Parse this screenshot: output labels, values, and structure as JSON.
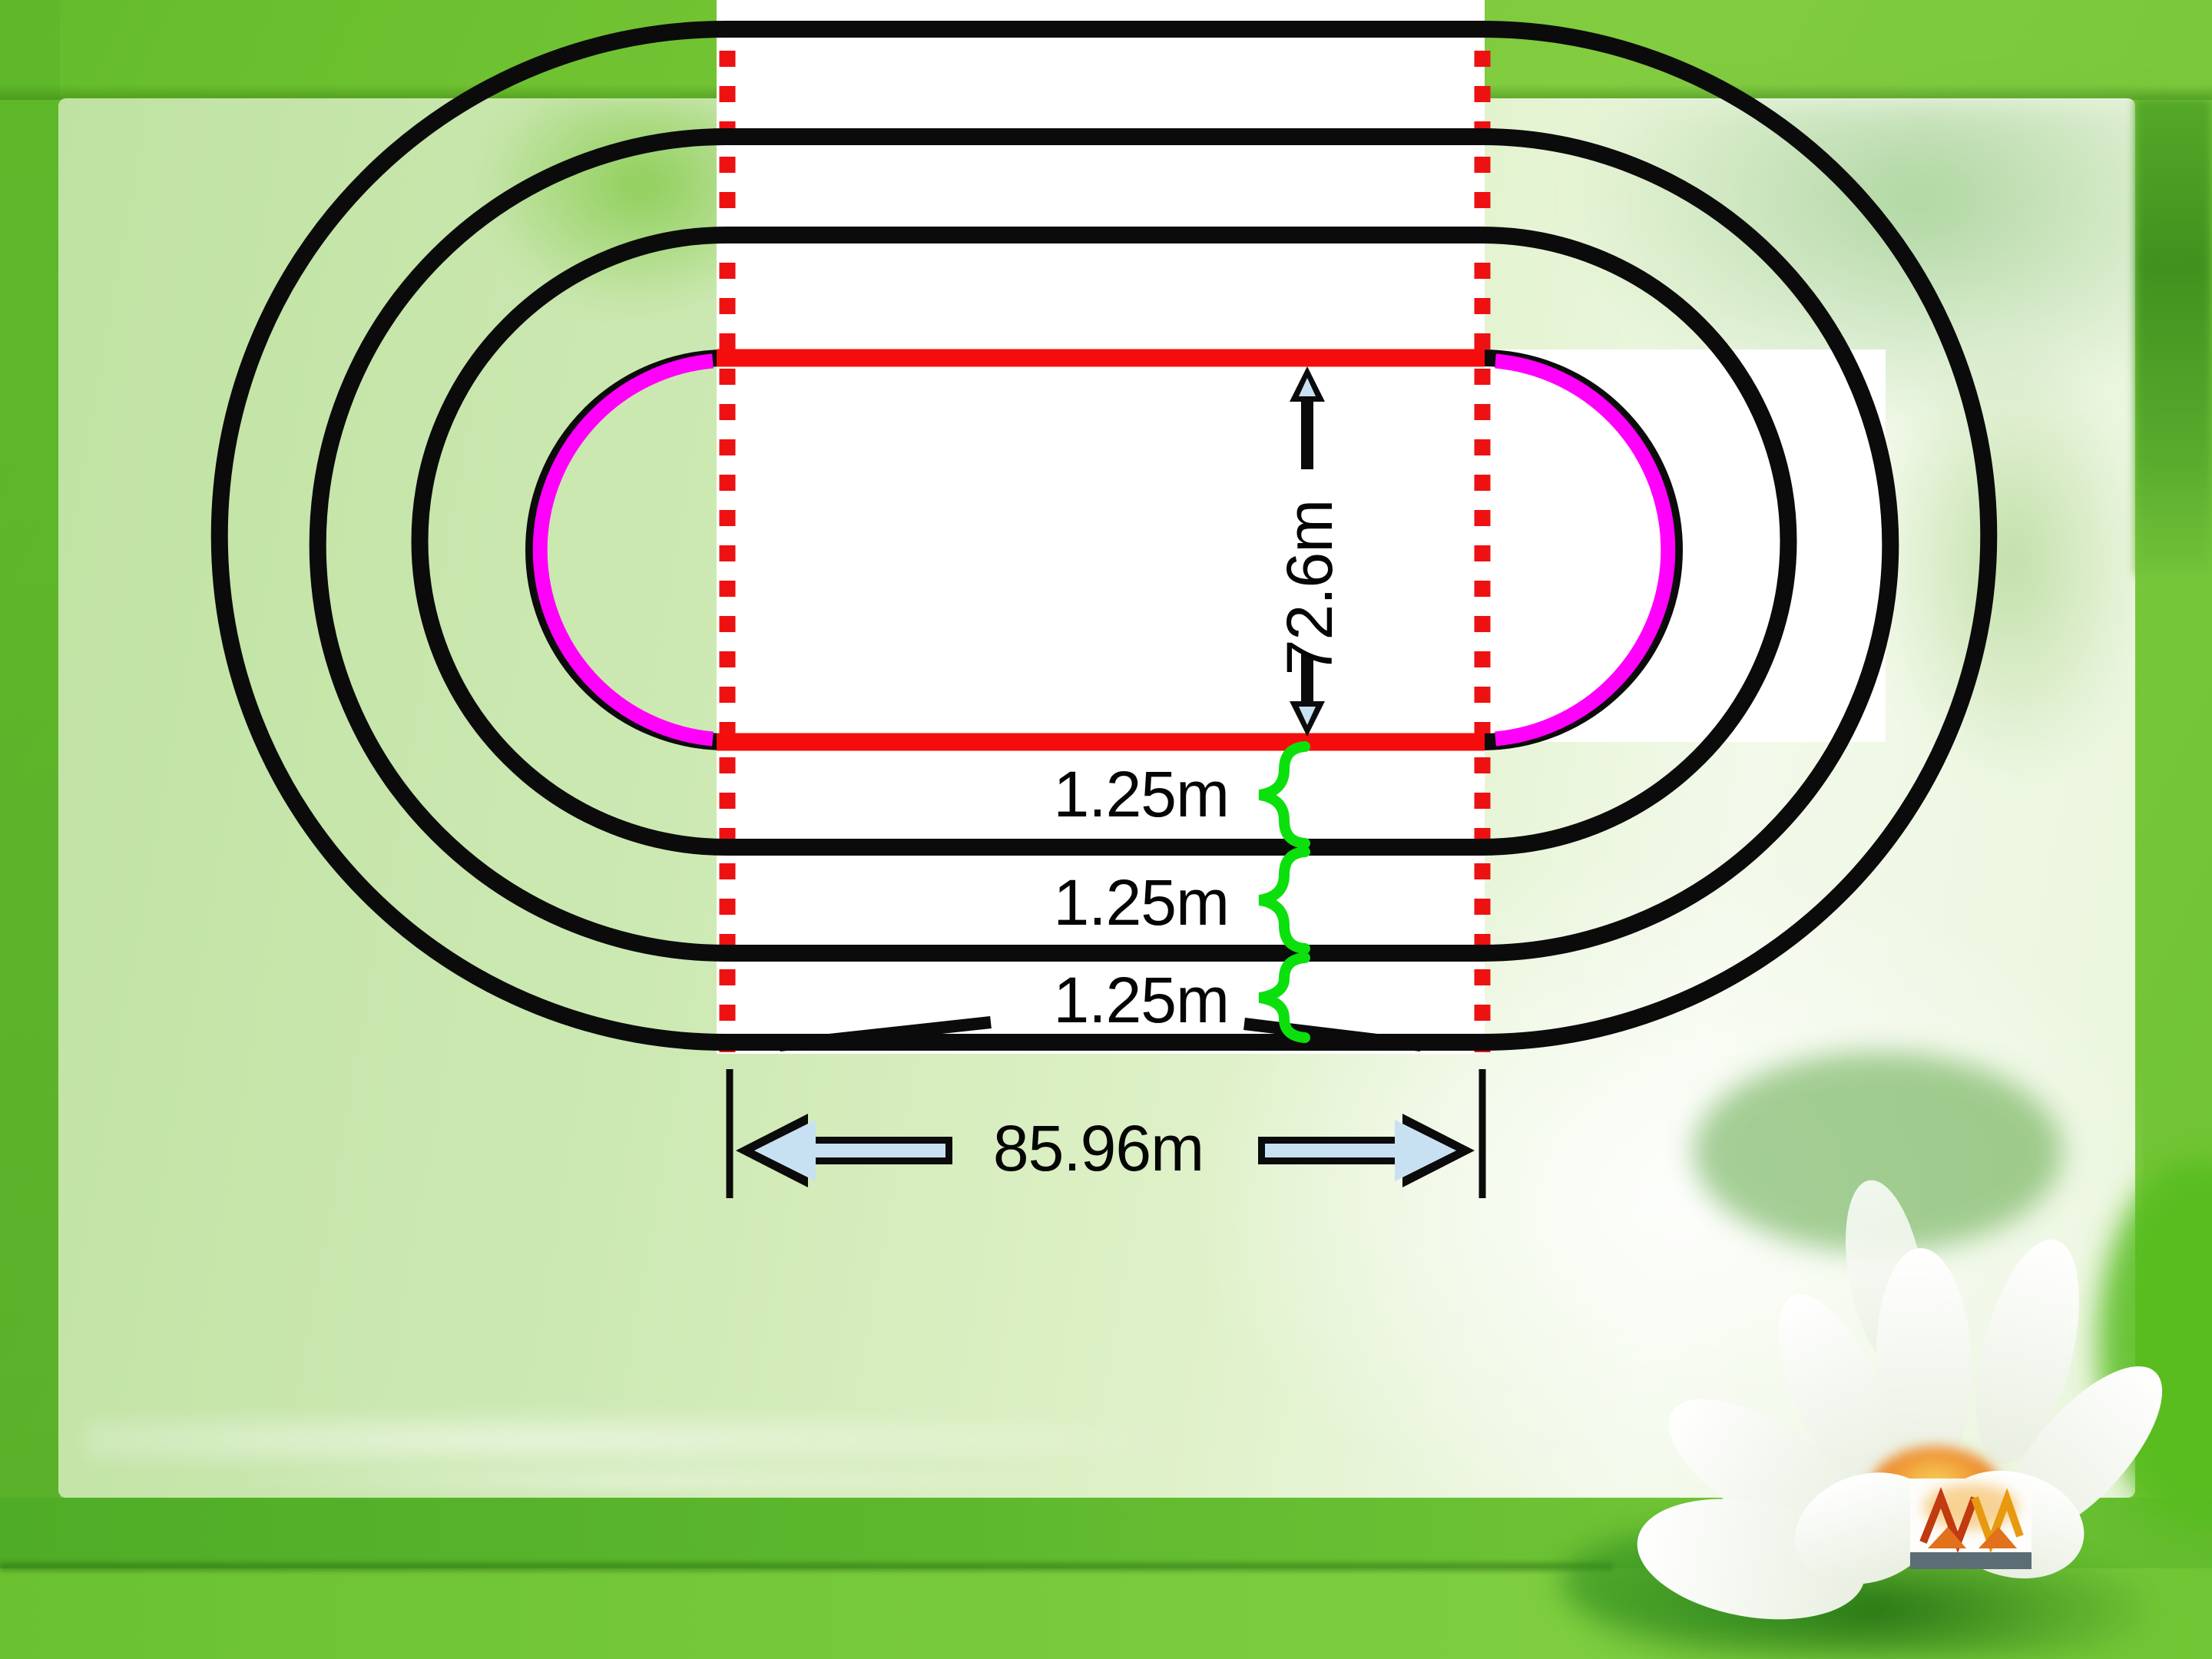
{
  "diagram": {
    "field_width_label": "72.6m",
    "straight_length_label": "85.96m",
    "lane_width_labels": [
      "1.25m",
      "1.25m",
      "1.25m"
    ]
  },
  "icons": {
    "up_arrow": "block-arrow-up",
    "down_arrow": "block-arrow-down",
    "left_arrow": "block-arrow-left",
    "right_arrow": "block-arrow-right",
    "lane_brace": "curly-brace",
    "logo": "mountain-monogram-logo",
    "flower": "lotus-flower"
  },
  "colors": {
    "track_line": "#0b0b0b",
    "inner_straight_red": "#f50d0d",
    "inner_curve_magenta": "#ff00fa",
    "guide_dot_red": "#ee1111",
    "brace_green": "#0ce00c",
    "arrow_fill_blue": "#c8e1f2",
    "frame_green": "#6abf2e",
    "panel_green": "#c9e6ac",
    "label_black": "#050505"
  }
}
